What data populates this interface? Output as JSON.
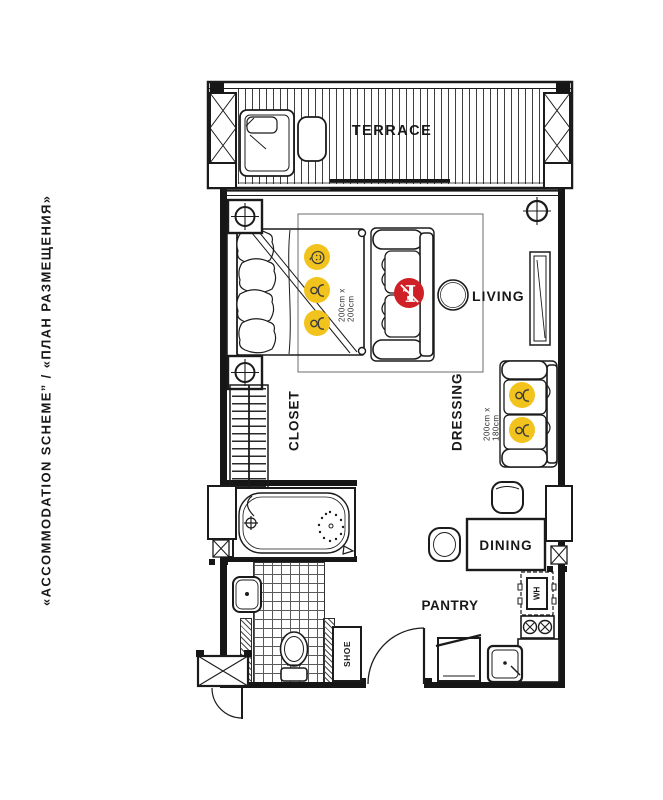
{
  "title": "«ACCOMMODATION SCHEME” / «ПЛАН РАЗМЕЩЕНИЯ»",
  "colors": {
    "occupant_badge_yellow": "#F2C31D",
    "restriction_badge_red": "#CE2026",
    "ink": "#181818"
  },
  "rooms": {
    "terrace": "TERRACE",
    "living": "LIVING",
    "closet": "CLOSET",
    "dressing": "DRESSING",
    "dining": "DINING",
    "pantry": "PANTRY",
    "shoe_cabinet": "SHOE",
    "water_heater": "WH"
  },
  "bed": {
    "size_label": "200cm x 200cm",
    "occupants": [
      "baby",
      "adult",
      "adult"
    ]
  },
  "dressing_sofa": {
    "size_label": "200cm x 180cm",
    "occupants": [
      "adult",
      "adult"
    ]
  },
  "living_sofa": {
    "restriction": "no-extra-bed"
  }
}
